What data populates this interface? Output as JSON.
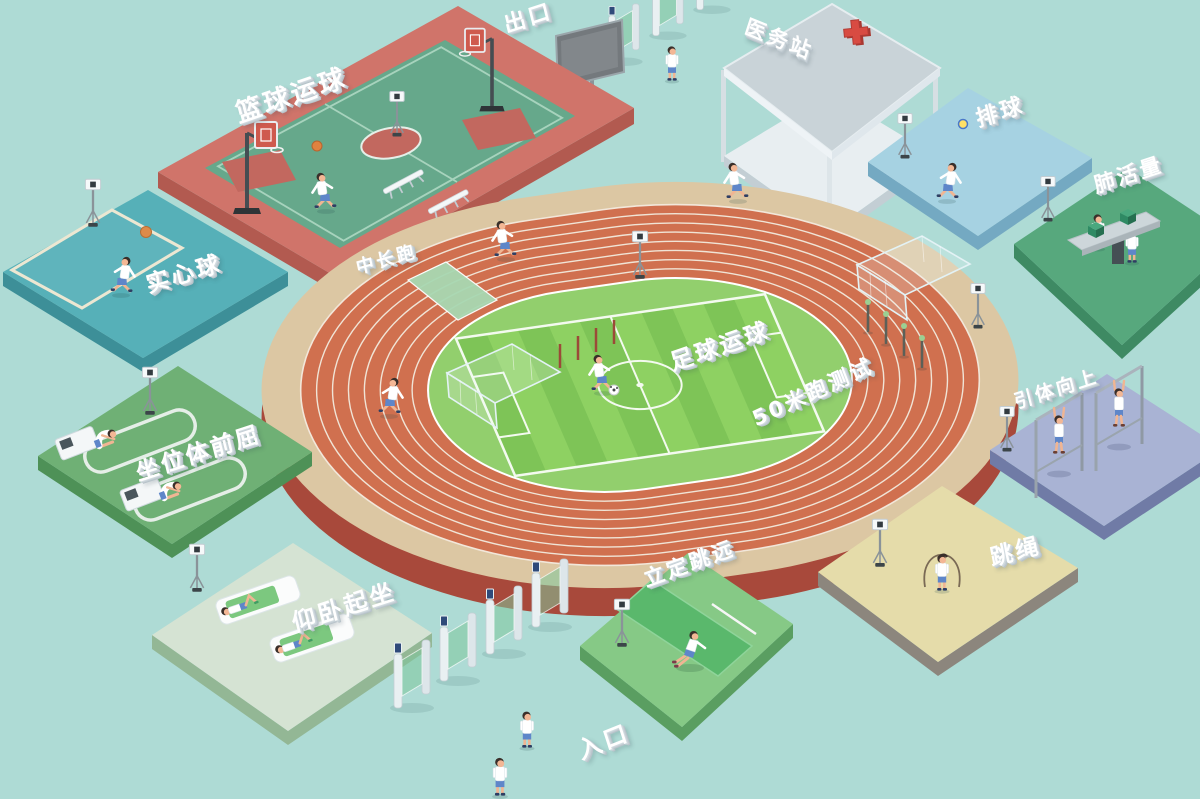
{
  "scene": {
    "description_labels_language": "zh-CN",
    "colors": {
      "background": "#aedbd5",
      "track_lanes": "#d0704f",
      "track_base": "#a8493b",
      "track_outer_ring": "#dcc7a3",
      "field_green_dark": "#7ec457",
      "field_green_light": "#8ed162",
      "basketball_platform": "#d0746a",
      "basketball_court": "#66a88b",
      "medicine_ball_platform": "#56b0b8",
      "sit_and_reach_platform": "#6fb075",
      "sit_up_platform": "#d5e3d3",
      "long_jump_platform": "#86c986",
      "rope_platform": "#e5dcaa",
      "pull_up_platform": "#a9b3d4",
      "vital_capacity_platform": "#57a87d",
      "volleyball_platform": "#a6d2e2",
      "pavilion_roof": "#c9d3d8",
      "red_cross": "#d84b42",
      "turnstile_glass": "#80c69c",
      "label_text": "#ffffff"
    }
  },
  "stations": {
    "basketball_dribble": {
      "label": "篮球运球"
    },
    "exit_gate": {
      "label": "出口"
    },
    "medical_station": {
      "label": "医务站"
    },
    "volleyball": {
      "label": "排球"
    },
    "vital_capacity": {
      "label": "肺活量"
    },
    "pull_up": {
      "label": "引体向上"
    },
    "rope_skipping": {
      "label": "跳绳"
    },
    "standing_long_jump": {
      "label": "立定跳远"
    },
    "sit_up": {
      "label": "仰卧起坐"
    },
    "entrance_gate": {
      "label": "入口"
    },
    "sit_and_reach": {
      "label": "坐位体前屈"
    },
    "medicine_ball": {
      "label": "实心球"
    },
    "middle_distance_run": {
      "label": "中长跑"
    },
    "football_dribble": {
      "label": "足球运球"
    },
    "sprint_50m_test": {
      "label": "50米跑测试"
    }
  }
}
